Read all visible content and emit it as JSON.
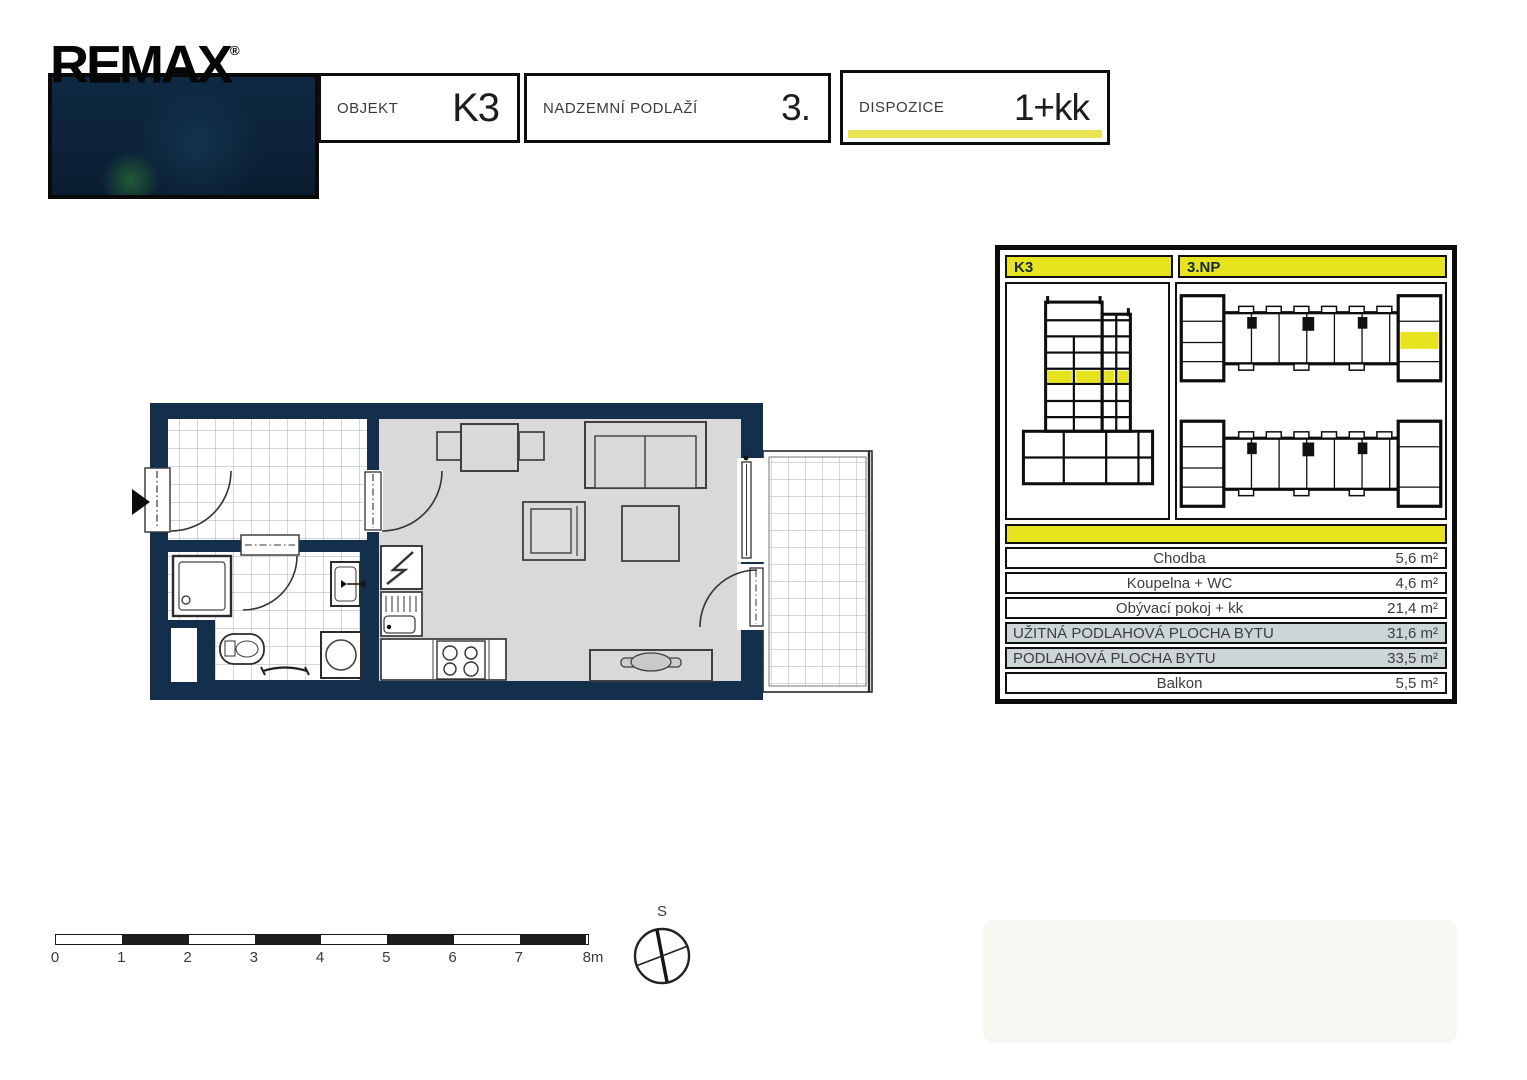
{
  "brand": {
    "logo_text": "REMAX",
    "registered": "®"
  },
  "header": {
    "fields": [
      {
        "label": "OBJEKT",
        "value": "K3"
      },
      {
        "label": "NADZEMNÍ PODLAŽÍ",
        "value": "3."
      },
      {
        "label": "DISPOZICE",
        "value": "1+kk"
      }
    ]
  },
  "info_panel": {
    "building_label": "K3",
    "floor_label": "3.NP",
    "rows": [
      {
        "label": "Chodba",
        "value": "5,6 m²",
        "emphasis": false
      },
      {
        "label": "Koupelna + WC",
        "value": "4,6 m²",
        "emphasis": false
      },
      {
        "label": "Obývací pokoj + kk",
        "value": "21,4 m²",
        "emphasis": false
      },
      {
        "label": "UŽITNÁ PODLAHOVÁ PLOCHA BYTU",
        "value": "31,6 m²",
        "emphasis": true
      },
      {
        "label": "PODLAHOVÁ PLOCHA BYTU",
        "value": "33,5 m²",
        "emphasis": true
      },
      {
        "label": "Balkon",
        "value": "5,5 m²",
        "emphasis": false
      }
    ]
  },
  "scale_bar": {
    "ticks": [
      "0",
      "1",
      "2",
      "3",
      "4",
      "5",
      "6",
      "7",
      "8m"
    ]
  },
  "compass": {
    "north_label": "S"
  },
  "colors": {
    "navy_wall": "#142f4b",
    "accent_yellow": "#e7e41f",
    "pale_yellow": "#e9e550",
    "floor_gray": "#d9d9d9",
    "row_gray": "#ccd5d7",
    "tile_line": "#9fadbd"
  }
}
